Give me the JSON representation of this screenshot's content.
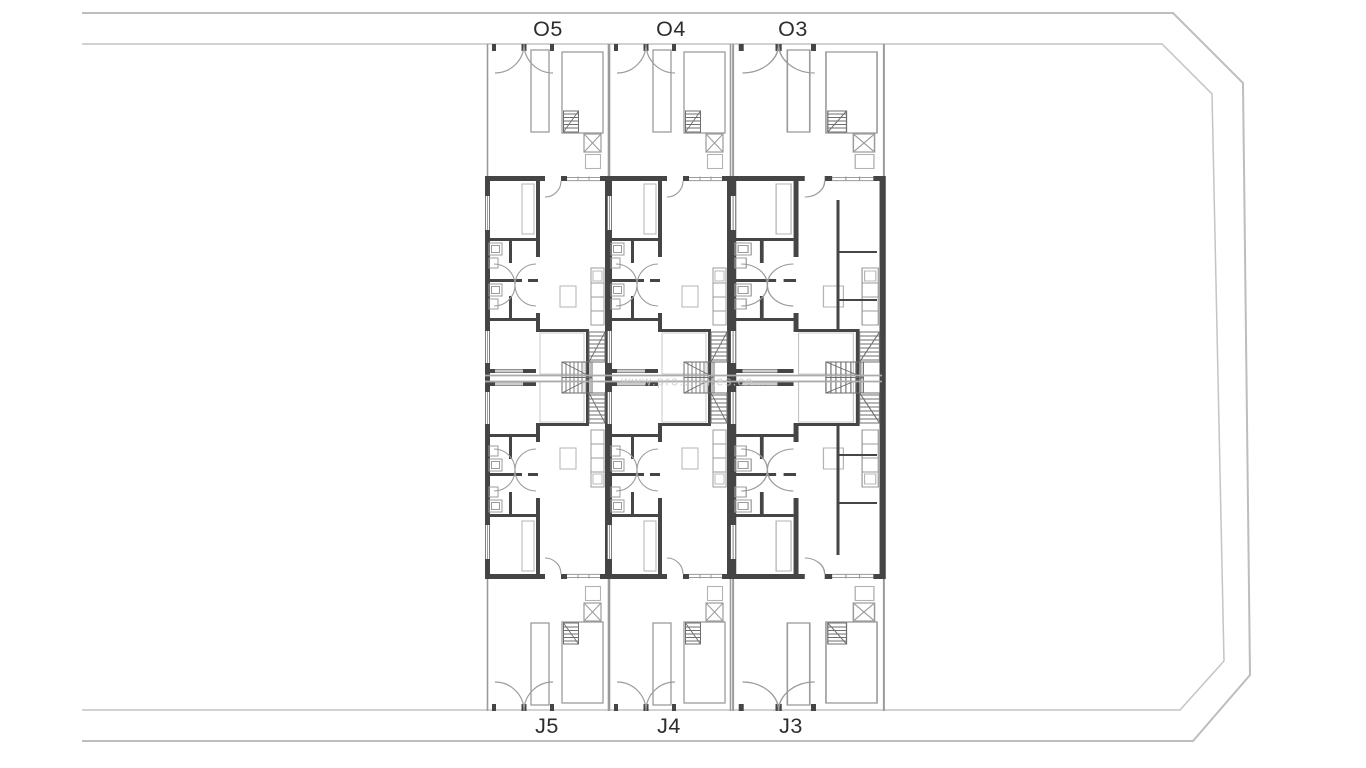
{
  "plan": {
    "top_row_labels": [
      "O5",
      "O4",
      "O3"
    ],
    "bottom_row_labels": [
      "J5",
      "J4",
      "J3"
    ],
    "watermark_text": "www.pro....sites.co...",
    "colors": {
      "wall": "#454545",
      "thin_line": "#9b9b9b",
      "stair_line": "#6e6e6e",
      "site_boundary": "#bdbdbd",
      "party_wall": "#ababab",
      "label_text": "#2d2d2d",
      "watermark": "#c9c9c9",
      "background": "#ffffff"
    }
  }
}
